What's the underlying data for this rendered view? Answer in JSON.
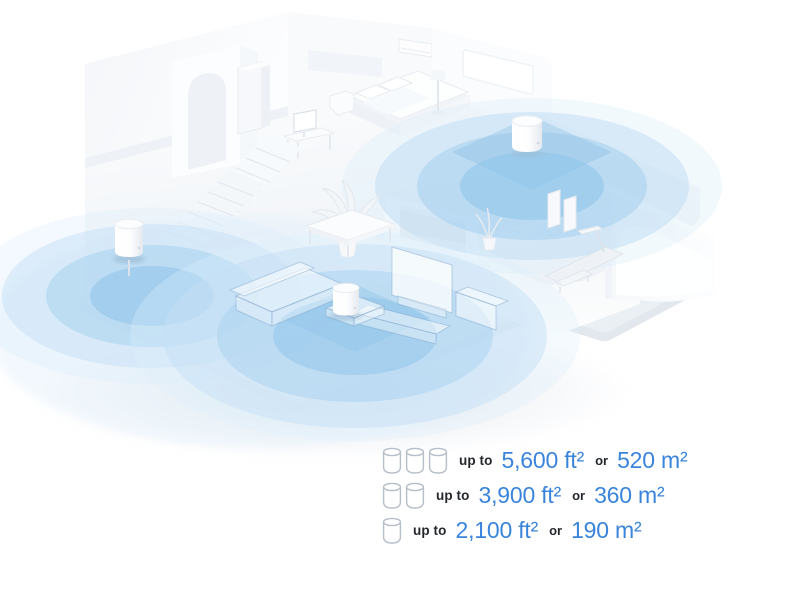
{
  "illustration": {
    "subject": "isometric two-story home with mesh wifi coverage",
    "device_name": "mesh-wifi-unit",
    "device_count": 3,
    "colors": {
      "background": "#ffffff",
      "structure_white": "#f8fafc",
      "structure_shade": "#e9edf2",
      "coverage_outer": "#d9ecfa",
      "coverage_mid": "#a8d2ef",
      "coverage_inner": "#8ec3e9"
    }
  },
  "legend": {
    "accent_color": "#3a85db",
    "text_color": "#24282c",
    "rows": [
      {
        "units": 3,
        "prefix": "up to",
        "imperial": "5,600 ft²",
        "conjunction": "or",
        "metric": "520 m²"
      },
      {
        "units": 2,
        "prefix": "up to",
        "imperial": "3,900 ft²",
        "conjunction": "or",
        "metric": "360 m²"
      },
      {
        "units": 1,
        "prefix": "up to",
        "imperial": "2,100 ft²",
        "conjunction": "or",
        "metric": "190 m²"
      }
    ]
  }
}
